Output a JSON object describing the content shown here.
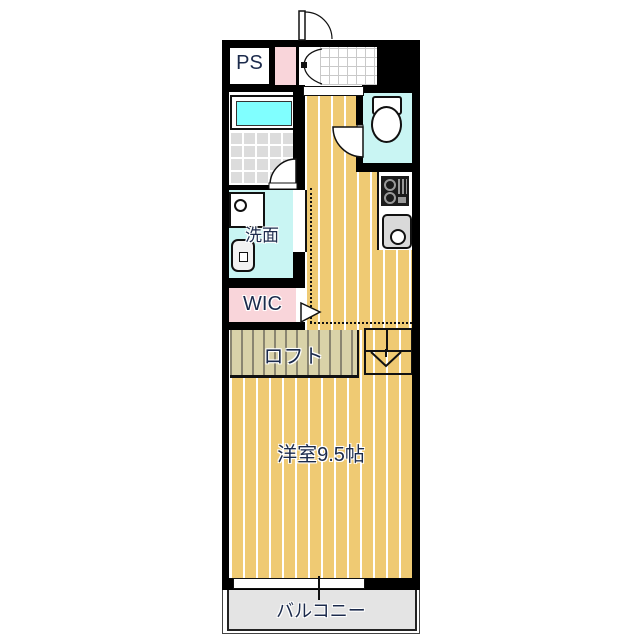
{
  "floor_plan": {
    "labels": {
      "ps": "PS",
      "washroom": "洗面",
      "wic": "WIC",
      "loft": "ロフト",
      "main_room": "洋室9.5帖",
      "balcony": "バルコニー"
    },
    "colors": {
      "wall": "#000000",
      "wood_floor": "#EFCA73",
      "loft_floor": "#D9D2A8",
      "bathtub_cyan": "#80FFFF",
      "wet_area_floor": "#C9F5F3",
      "closet_pink": "#F9D5DA",
      "balcony_gray": "#E4E4E4",
      "bath_tile_gray": "#DCDCDC",
      "label_text": "#1C2B4C"
    }
  }
}
